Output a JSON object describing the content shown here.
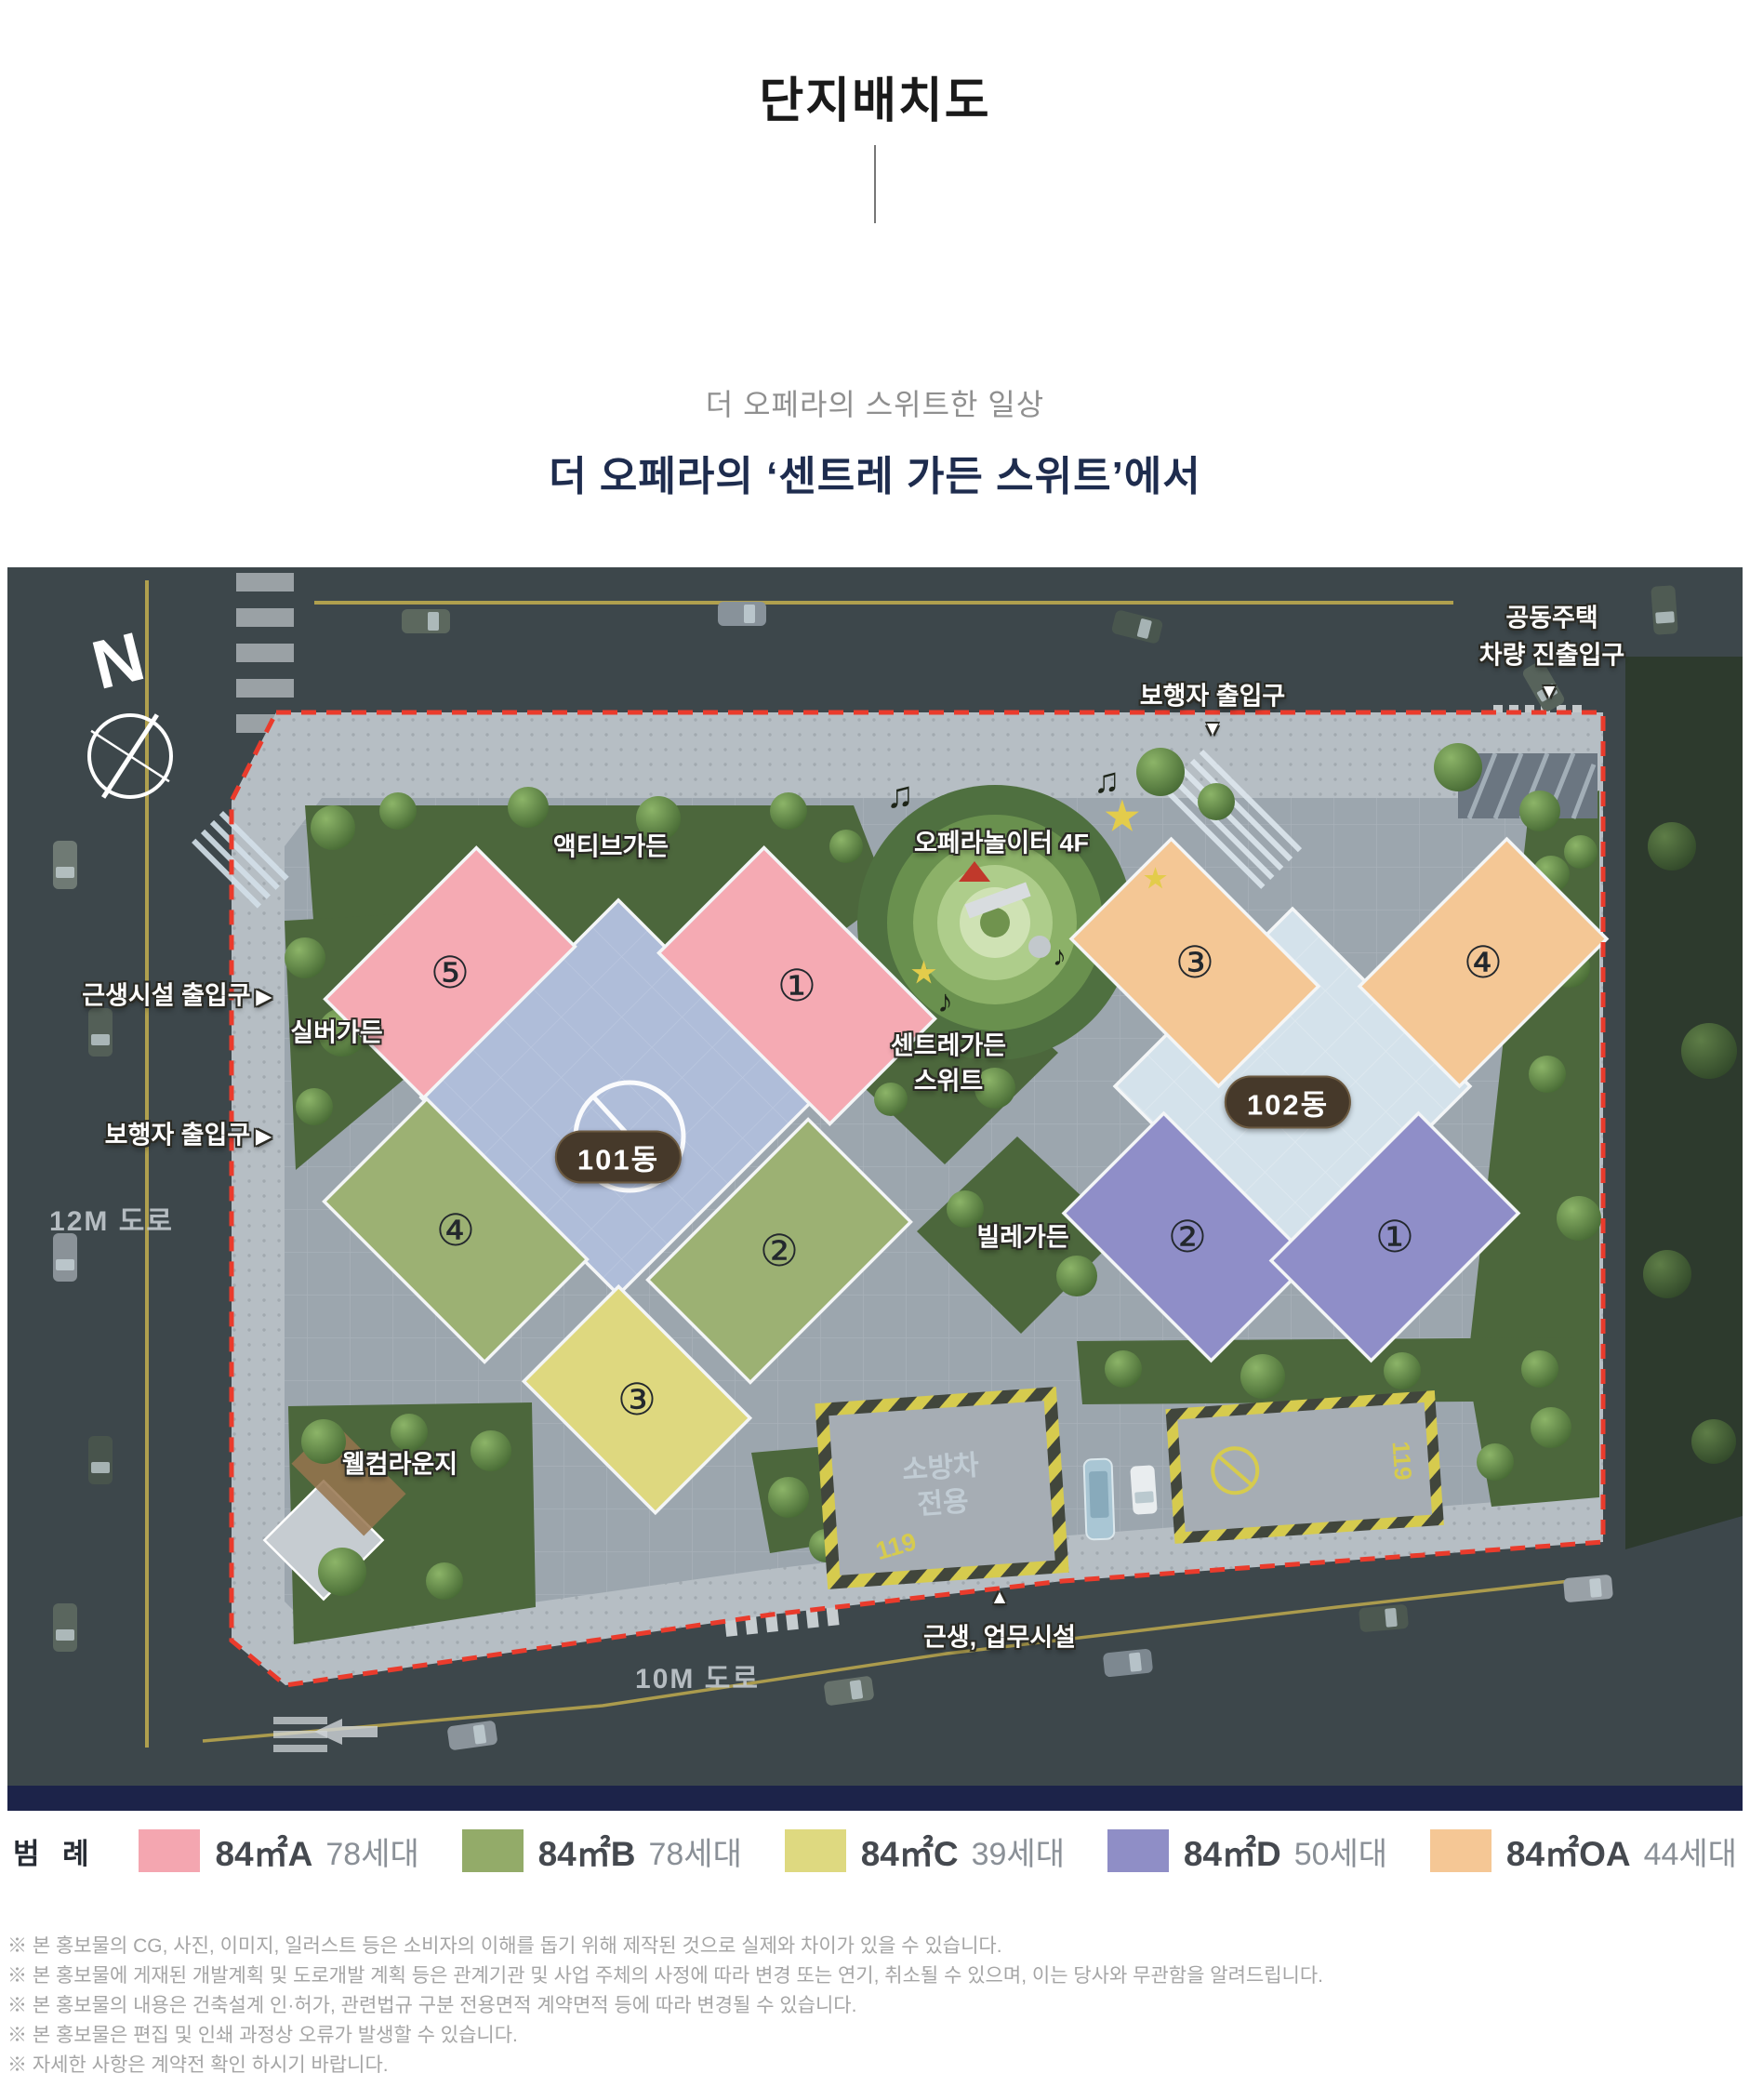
{
  "header": {
    "title": "단지배치도",
    "subtitle_light": "더 오페라의 스위트한 일상",
    "subtitle_bold": "더 오페라의 ‘센트레 가든 스위트’에서"
  },
  "map": {
    "compass_letter": "N",
    "labels": {
      "pedestrian_entrance_top": "보행자 출입구",
      "apartment_vehicle_entrance_1": "공동주택",
      "apartment_vehicle_entrance_2": "차량 진출입구",
      "retail_entrance_left": "근생시설 출입구",
      "silver_garden": "실버가든",
      "pedestrian_entrance_left": "보행자 출입구",
      "road_12m": "12M 도로",
      "active_garden": "액티브가든",
      "opera_playground": "오페라놀이터 4F",
      "centre_garden_1": "센트레가든",
      "centre_garden_2": "스위트",
      "ville_garden": "빌레가든",
      "welcome_lounge": "웰컴라운지",
      "retail_office_bottom": "근생, 업무시설",
      "road_10m": "10M 도로"
    },
    "building_tags": {
      "b101": "101동",
      "b102": "102동"
    },
    "units": {
      "p5": "⑤",
      "p1": "①",
      "g4": "④",
      "g2": "②",
      "y3": "③",
      "o3": "③",
      "o4": "④",
      "v2": "②",
      "v1": "①"
    },
    "fire_lane": {
      "line1": "소방차",
      "line2": "전용",
      "code": "119"
    },
    "triangles": {
      "down": "▼",
      "up": "▲",
      "right": "▶"
    },
    "decor": {
      "note1": "♪",
      "note2": "♫",
      "star": "★"
    },
    "boundary_color": "#ea3b2c"
  },
  "legend": {
    "title": "범 례",
    "items": [
      {
        "label": "84㎡A",
        "count": "78세대",
        "color": "#f4a6b0"
      },
      {
        "label": "84㎡B",
        "count": "78세대",
        "color": "#93ab69"
      },
      {
        "label": "84㎡C",
        "count": "39세대",
        "color": "#ded980"
      },
      {
        "label": "84㎡D",
        "count": "50세대",
        "color": "#8f8ec6"
      },
      {
        "label": "84㎡OA",
        "count": "44세대",
        "color": "#f5c795"
      }
    ]
  },
  "footnotes": [
    "※ 본 홍보물의 CG, 사진, 이미지, 일러스트 등은 소비자의 이해를 돕기 위해 제작된 것으로 실제와 차이가 있을 수 있습니다.",
    "※ 본 홍보물에 게재된 개발계획 및 도로개발 계획 등은 관계기관 및 사업 주체의 사정에 따라 변경 또는 연기, 취소될 수 있으며, 이는 당사와 무관함을 알려드립니다.",
    "※ 본 홍보물의 내용은 건축설계 인·허가, 관련법규 구분 전용면적 계약면적 등에 따라 변경될 수 있습니다.",
    "※ 본 홍보물은 편집 및 인쇄 과정상 오류가 발생할 수 있습니다.",
    "※ 자세한 사항은 계약전 확인 하시기 바랍니다."
  ]
}
